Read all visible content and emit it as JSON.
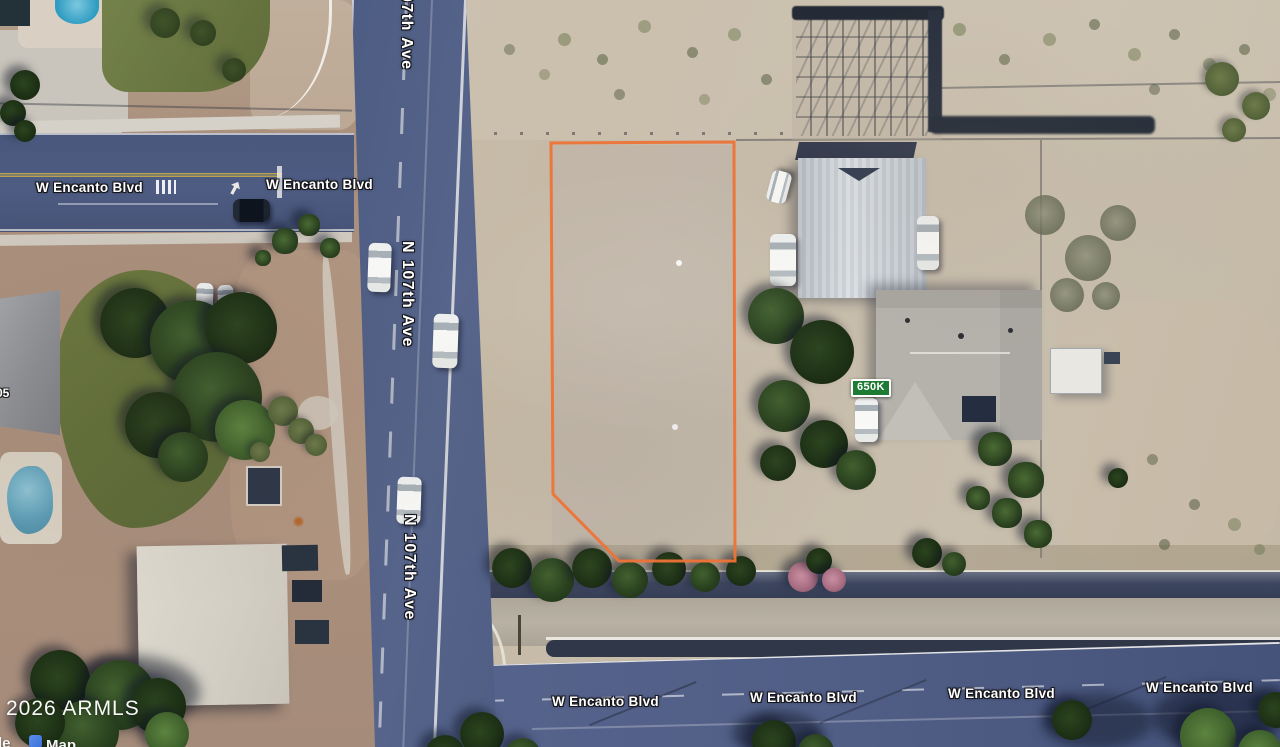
{
  "map": {
    "watermark": "2026 ARMLS",
    "price_badge": {
      "label": "650K",
      "bg_color": "#1E7B33",
      "border_color": "#FFFFFF"
    },
    "property_outline_color": "#EE7337",
    "street_labels": [
      {
        "id": "encanto-top-west",
        "text": "W Encanto Blvd"
      },
      {
        "id": "encanto-top-east",
        "text": "W Encanto Blvd"
      },
      {
        "id": "n107th-top-partial",
        "text": "07th Ave"
      },
      {
        "id": "n107th-middle",
        "text": "N 107th Ave"
      },
      {
        "id": "n107th-south",
        "text": "N 107th Ave"
      },
      {
        "id": "encanto-bottom-1",
        "text": "W Encanto Blvd"
      },
      {
        "id": "encanto-bottom-2",
        "text": "W Encanto Blvd"
      },
      {
        "id": "encanto-bottom-3",
        "text": "W Encanto Blvd"
      },
      {
        "id": "encanto-bottom-4",
        "text": "W Encanto Blvd"
      }
    ],
    "house_number_partial": "05",
    "attribution_partial": {
      "left": "le",
      "right": "Map"
    }
  }
}
